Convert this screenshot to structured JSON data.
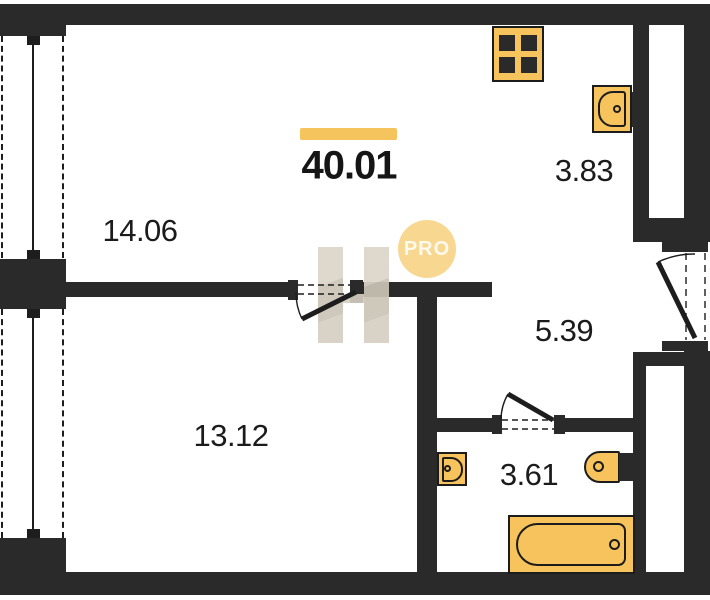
{
  "plan": {
    "total_area": "40.01",
    "rooms": [
      {
        "id": "living-room",
        "area": "14.06"
      },
      {
        "id": "kitchen-nook",
        "area": "3.83"
      },
      {
        "id": "hallway",
        "area": "5.39"
      },
      {
        "id": "bedroom",
        "area": "13.12"
      },
      {
        "id": "bathroom",
        "area": "3.61"
      }
    ],
    "watermark": {
      "label": "PRO"
    },
    "colors": {
      "wall": "#2a2a2a",
      "fixture_fill": "#f6c35c",
      "fixture_outline": "#1c1c1c",
      "accent_bar": "#f5c45c",
      "watermark_circle": "#f8d791",
      "watermark_beige": "#d6cfc2",
      "label_text": "#1b1b1b"
    },
    "icons": [
      "stove-icon",
      "kitchen-sink-icon",
      "washbasin-icon",
      "toilet-icon",
      "bathtub-icon",
      "window-icon",
      "door-swing-icon"
    ]
  }
}
